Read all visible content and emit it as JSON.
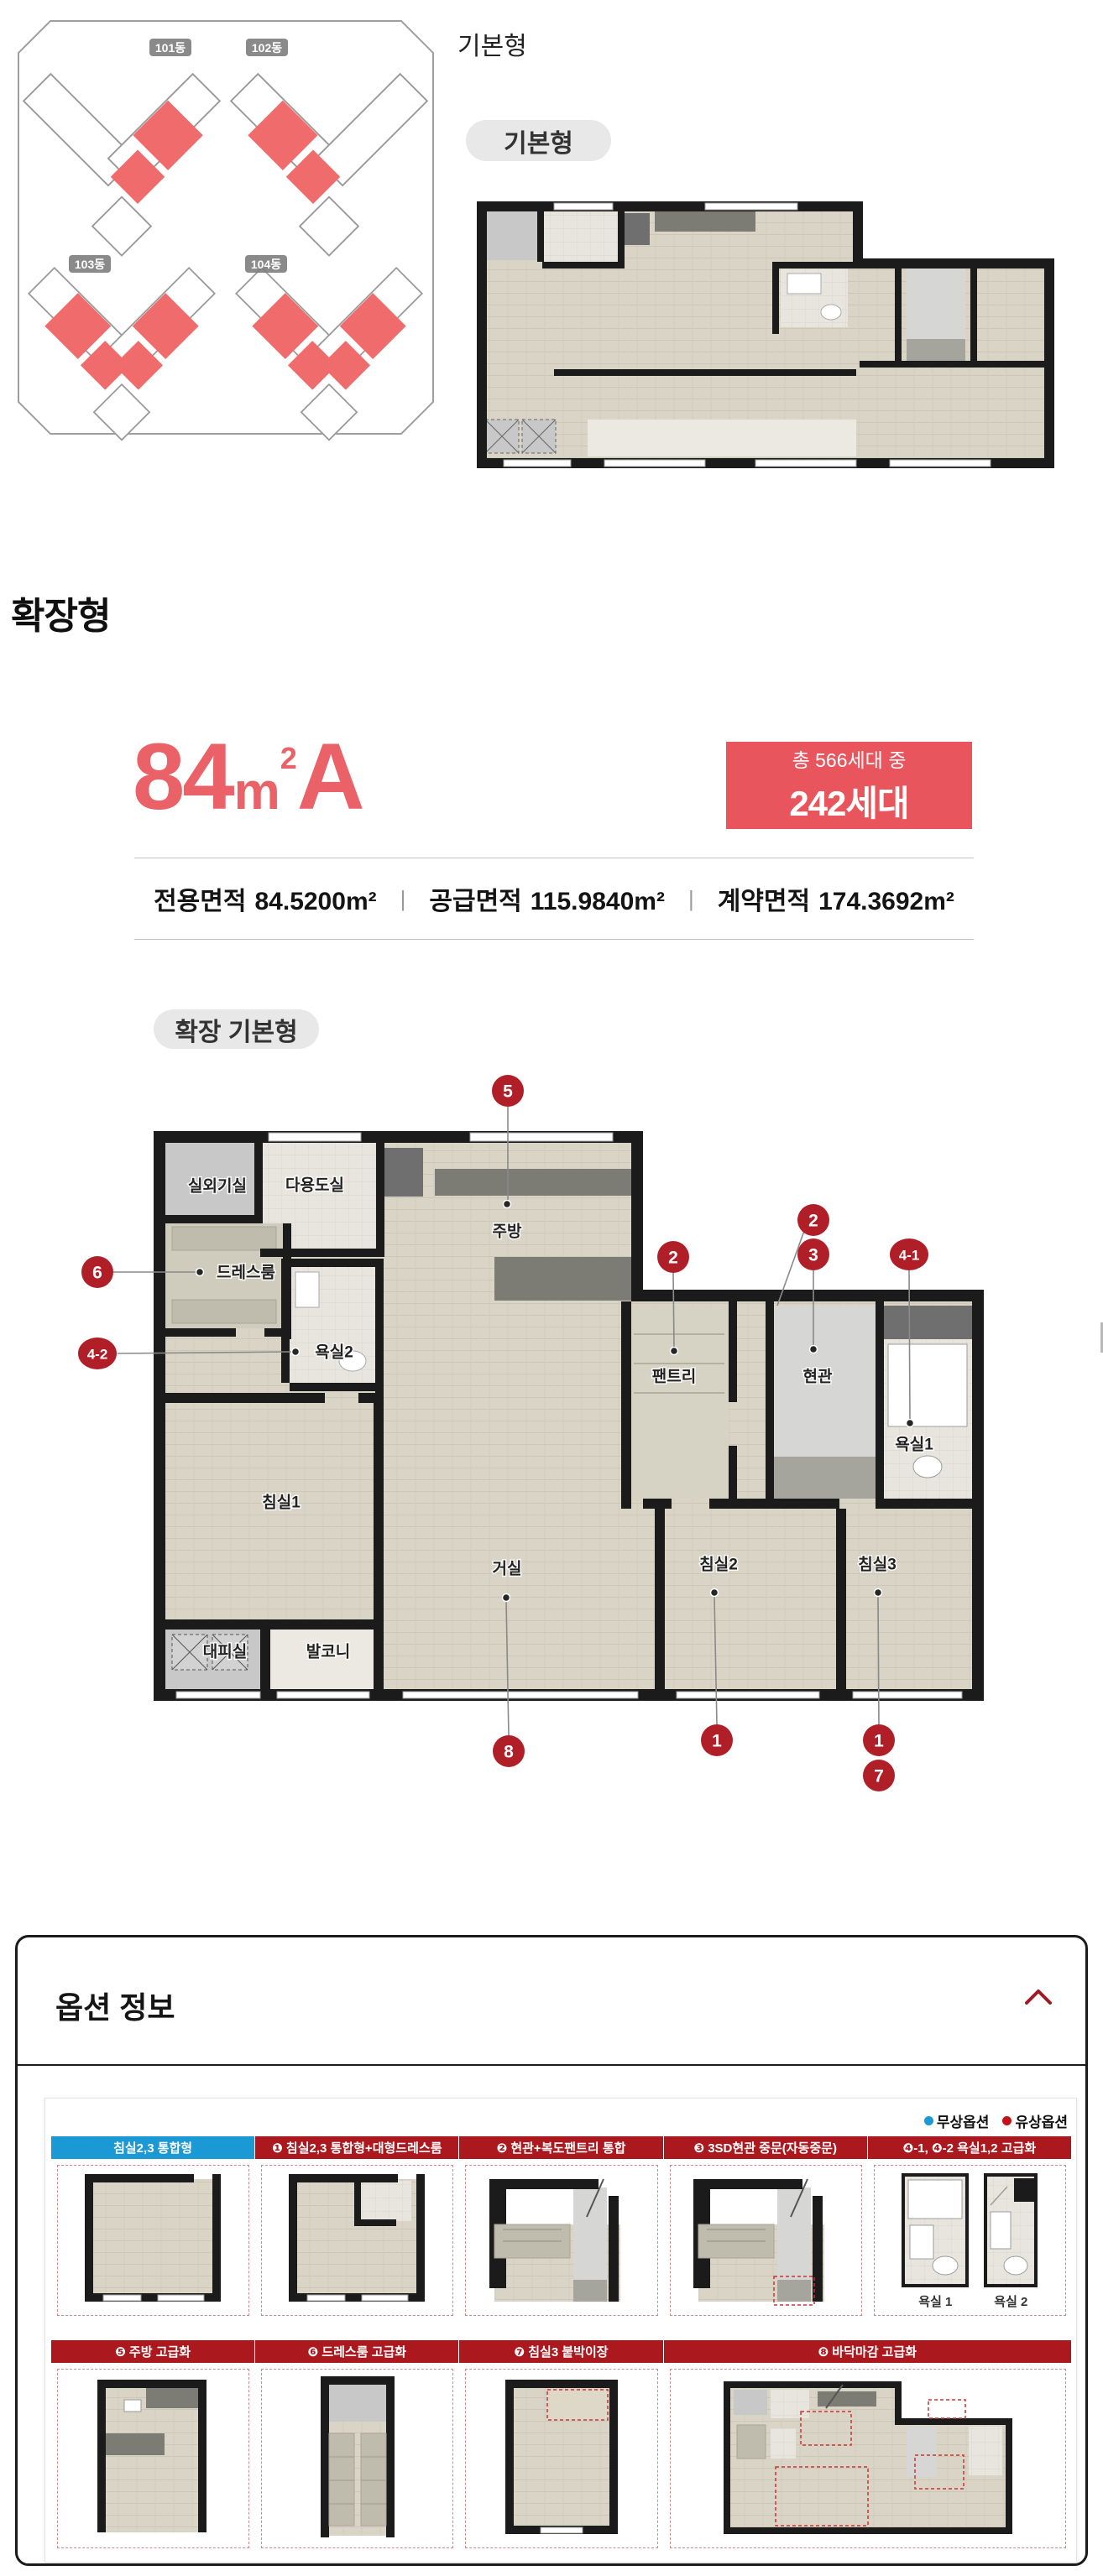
{
  "top": {
    "heading": "기본형",
    "pill": "기본형",
    "buildings": [
      {
        "label": "101동"
      },
      {
        "label": "102동"
      },
      {
        "label": "103동"
      },
      {
        "label": "104동"
      }
    ]
  },
  "expanded": {
    "heading": "확장형",
    "pill": "확장 기본형"
  },
  "unit": {
    "num": "84",
    "unit": "m",
    "sup": "2",
    "type": "A",
    "badge1": "총 566세대 중",
    "badge2": "242세대",
    "divider": "|",
    "areas": [
      {
        "label": "전용면적",
        "value": "84.5200",
        "unit": "m²"
      },
      {
        "label": "공급면적",
        "value": "115.9840",
        "unit": "m²"
      },
      {
        "label": "계약면적",
        "value": "174.3692",
        "unit": "m²"
      }
    ]
  },
  "plan": {
    "rooms": [
      {
        "label": "실외기실"
      },
      {
        "label": "다용도실"
      },
      {
        "label": "주방"
      },
      {
        "label": "드레스룸"
      },
      {
        "label": "욕실2"
      },
      {
        "label": "침실1"
      },
      {
        "label": "대피실"
      },
      {
        "label": "발코니"
      },
      {
        "label": "거실"
      },
      {
        "label": "팬트리"
      },
      {
        "label": "현관"
      },
      {
        "label": "욕실1"
      },
      {
        "label": "침실2"
      },
      {
        "label": "침실3"
      }
    ],
    "markers": [
      {
        "label": "5"
      },
      {
        "label": "6"
      },
      {
        "label": "4-2"
      },
      {
        "label": "2"
      },
      {
        "label": "2"
      },
      {
        "label": "3"
      },
      {
        "label": "4-1"
      },
      {
        "label": "8"
      },
      {
        "label": "1"
      },
      {
        "label": "1"
      },
      {
        "label": "7"
      }
    ]
  },
  "options": {
    "title": "옵션 정보",
    "legend": [
      {
        "label": "무상옵션",
        "color": "#1b99d5"
      },
      {
        "label": "유상옵션",
        "color": "#c51118"
      }
    ],
    "row1": [
      {
        "label": "침실2,3 통합형"
      },
      {
        "label": "❶ 침실2,3 통합형+대형드레스룸"
      },
      {
        "label": "❷ 현관+복도팬트리 통합"
      },
      {
        "label": "❸ 3SD현관 중문(자동중문)"
      },
      {
        "label": "❹-1, ❹-2 욕실1,2 고급화"
      }
    ],
    "bath": [
      {
        "label": "욕실 1"
      },
      {
        "label": "욕실 2"
      }
    ],
    "row2": [
      {
        "label": "❺ 주방 고급화"
      },
      {
        "label": "❻ 드레스룸 고급화"
      },
      {
        "label": "❼ 침실3 붙박이장"
      },
      {
        "label": "❽ 바닥마감 고급화"
      }
    ]
  },
  "colors": {
    "accent_red": "#e8555c",
    "unit_highlight_red": "#f06b6b",
    "marker_red": "#b01f27",
    "header_red": "#ab181e",
    "header_blue": "#1b99d5"
  }
}
